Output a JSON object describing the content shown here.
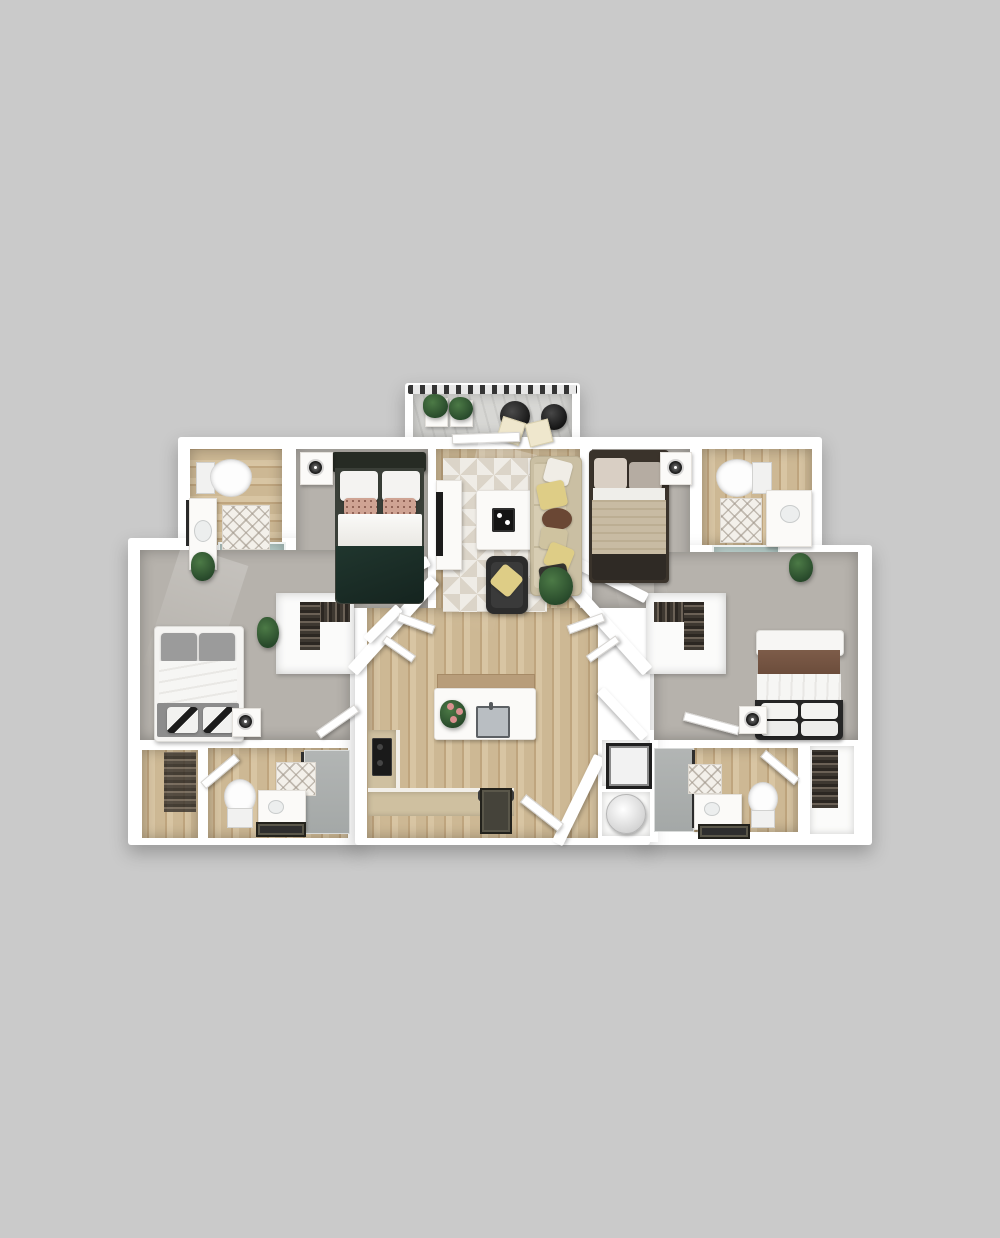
{
  "scene": {
    "type": "3d-apartment-floor-plan-render",
    "view": "top-down dollhouse",
    "rooms": [
      {
        "name": "balcony",
        "floor": "gray deck planks",
        "items": [
          "railing",
          "planter-box",
          "planter-box",
          "round-bistro-table",
          "round-side-table",
          "patio-chair",
          "patio-chair"
        ]
      },
      {
        "name": "living-room",
        "floor": "light oak wood",
        "items": [
          "geometric-area-rug",
          "tv-console",
          "tv",
          "coffee-table",
          "serving-tray",
          "sofa",
          "throw-pillows",
          "accent-armchair",
          "potted-plant"
        ]
      },
      {
        "name": "bedroom-top-left",
        "floor": "gray carpet",
        "items": [
          "bed-green-duvet",
          "headboard",
          "pillows",
          "nightstand",
          "table-lamp"
        ]
      },
      {
        "name": "bedroom-top-right",
        "floor": "gray carpet",
        "items": [
          "bed-tan-duvet",
          "pillows",
          "nightstand",
          "table-lamp"
        ]
      },
      {
        "name": "bedroom-left",
        "floor": "gray carpet",
        "items": [
          "bed-white-duvet",
          "gray-pillows",
          "foot-bench",
          "patterned-pillows",
          "nightstand",
          "table-lamp",
          "potted-plant"
        ]
      },
      {
        "name": "bedroom-right",
        "floor": "gray carpet",
        "items": [
          "bed-white-duvet",
          "brown-throw",
          "white-pillows",
          "nightstand",
          "table-lamp",
          "potted-plant"
        ]
      },
      {
        "name": "bathroom-top-left",
        "floor": "wood tile",
        "items": [
          "toilet",
          "vanity-sink",
          "diamond-bath-mat",
          "walk-in-shower-teal",
          "towel-bar"
        ]
      },
      {
        "name": "bathroom-top-right",
        "floor": "wood tile",
        "items": [
          "toilet",
          "vanity-sink",
          "diamond-bath-mat",
          "soaking-tub-teal",
          "towel-bar"
        ]
      },
      {
        "name": "bathroom-bottom-left",
        "floor": "wood tile",
        "items": [
          "entry-door",
          "toilet",
          "vanity-sink",
          "diamond-tile-wall",
          "glass-shower",
          "dark-bath-mat"
        ]
      },
      {
        "name": "bathroom-bottom-right",
        "floor": "wood tile",
        "items": [
          "entry-door",
          "toilet",
          "vanity-sink",
          "diamond-tile-wall",
          "glass-shower",
          "dark-bath-mat"
        ]
      },
      {
        "name": "kitchen",
        "floor": "light oak wood",
        "items": [
          "island-with-sink",
          "flower-vase",
          "l-shaped-counter",
          "cooktop",
          "dark-appliance-front",
          "upper-cabinet-band"
        ]
      },
      {
        "name": "entry",
        "floor": "light oak wood",
        "items": [
          "door-mat",
          "front-door",
          "angled-wall"
        ]
      },
      {
        "name": "walk-in-closet-left",
        "items": [
          "hanging-clothes",
          "open-doors"
        ]
      },
      {
        "name": "walk-in-closet-right",
        "items": [
          "hanging-clothes",
          "open-doors"
        ]
      },
      {
        "name": "laundry-closet",
        "items": [
          "stacked-washer-dryer",
          "water-heater"
        ]
      },
      {
        "name": "storage-closet-bottom-left",
        "items": [
          "shelving"
        ]
      },
      {
        "name": "storage-closet-bottom-right",
        "items": [
          "hanging-clothes"
        ]
      }
    ]
  },
  "palette": {
    "bg": "#cacaca",
    "wall": "#ffffff",
    "wood1": "#cdb894",
    "wood2": "#bfa57e",
    "wood3": "#d8c5a3",
    "carpet": "#b6b2ac",
    "deck": "#d7d7d4",
    "teal": "#c3d8d4",
    "showerGray": "#b2b5b4",
    "rug1": "#efece6",
    "rug2": "#dbd4c8",
    "greenBed": "#20362e",
    "headboardDark": "#262b24",
    "tanDuvet": "#c8bba3",
    "brownBlanket": "#7d5c49",
    "benchGray": "#8d8d8d",
    "pillowGray": "#9b9b9b",
    "sofa": "#cabfa3",
    "sofaCushion": "#d7cdb3",
    "yellow": "#decd86",
    "brownPillow": "#6a4734",
    "dark": "#232323",
    "plant": "#4c7a46",
    "plantDark": "#27482a",
    "flowerPink": "#d9908f",
    "matDark": "#45433a",
    "counterTan": "#cfc0a0"
  }
}
